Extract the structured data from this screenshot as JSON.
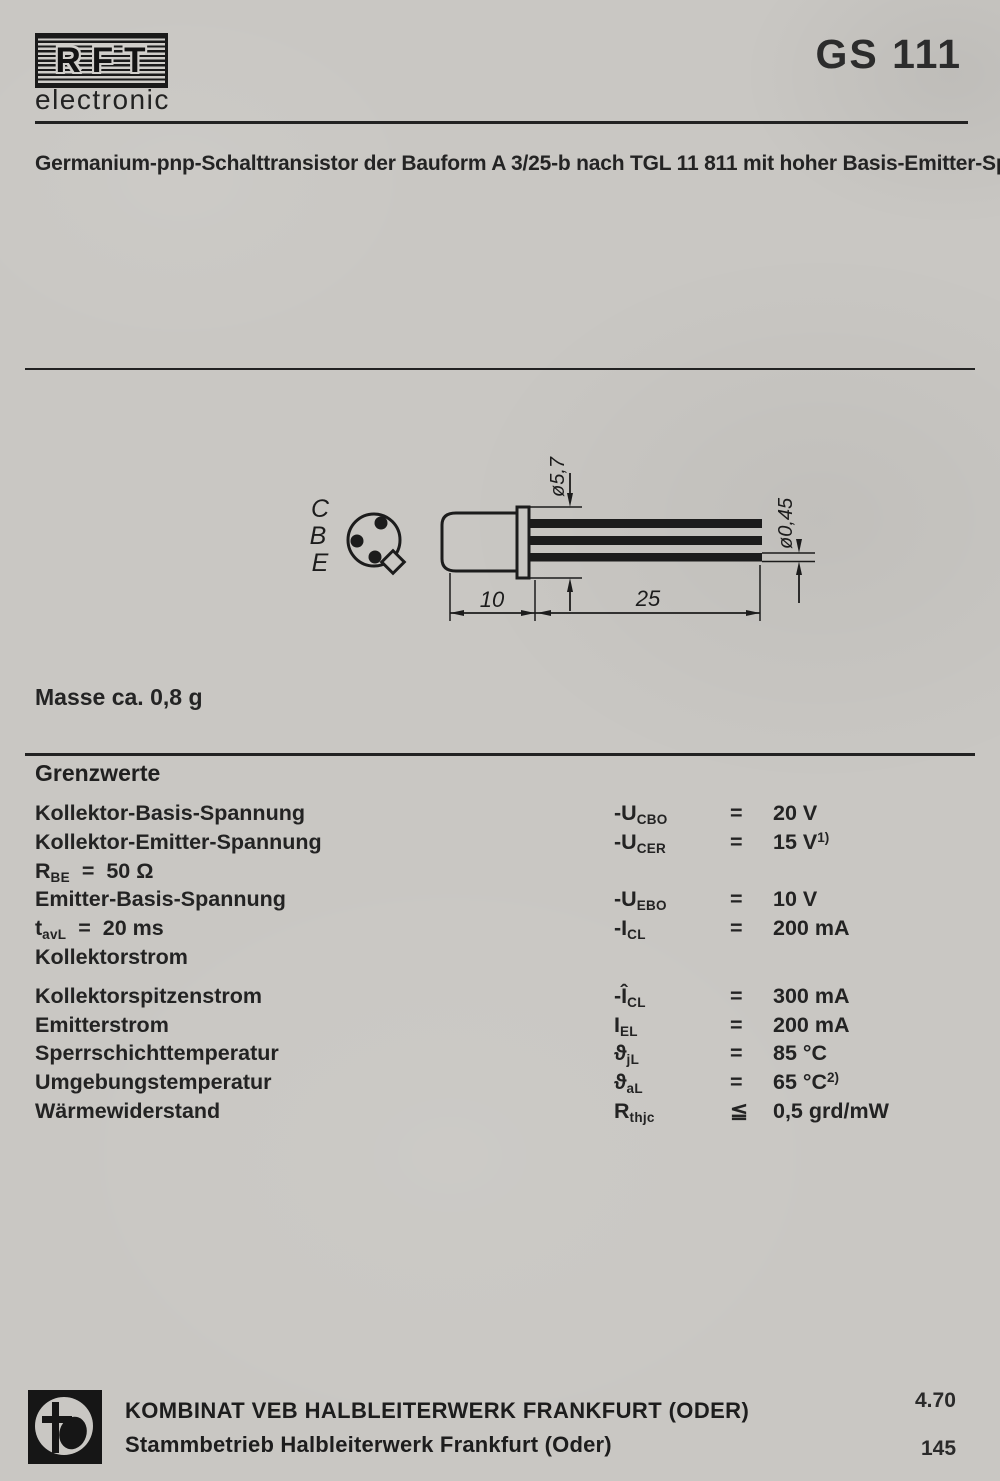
{
  "page": {
    "background": "#c9c7c3",
    "ink": "#1e1e1e"
  },
  "header": {
    "brand": "RFT",
    "brand_sub": "electronic",
    "model": "GS 111"
  },
  "description": "Germanium-pnp-Schalttransistor der Bauform A 3/25-b nach TGL 11 811 mit hoher Basis-Emitter-Spannungsfestigkeit für mittlere Geschwindigkeiten in logischen Schaltungen.",
  "drawing": {
    "pins": [
      "C",
      "B",
      "E"
    ],
    "dim_flange_diameter": "ø5,7",
    "dim_lead_diameter": "ø0,45",
    "dim_body_length": "10",
    "dim_lead_length": "25"
  },
  "mass_note": "Masse ca. 0,8 g",
  "limits": {
    "title": "Grenzwerte",
    "rows": [
      {
        "label": "Kollektor-Basis-Spannung",
        "sym": "-U",
        "sym_sub": "CBO",
        "rel": "=",
        "value": "20 V"
      },
      {
        "label": "Kollektor-Emitter-Spannung",
        "sym": "-U",
        "sym_sub": "CER",
        "rel": "=",
        "value": "15 V",
        "value_sup": "1)"
      },
      {
        "label": "R",
        "label_sub": "BE",
        "label_rest": "  =  50 Ω"
      },
      {
        "label": "Emitter-Basis-Spannung",
        "sym": "-U",
        "sym_sub": "EBO",
        "rel": "=",
        "value": "10 V"
      },
      {
        "label": "t",
        "label_sub": "avL",
        "label_rest": "  =  20 ms",
        "sym": "-I",
        "sym_sub": "CL",
        "rel": "=",
        "value": "200 mA"
      },
      {
        "label": "Kollektorstrom"
      },
      {
        "label": "Kollektorspitzenstrom",
        "sym": "-Î",
        "sym_sub": "CL",
        "rel": "=",
        "value": "300 mA"
      },
      {
        "label": "Emitterstrom",
        "sym": "I",
        "sym_sub": "EL",
        "rel": "=",
        "value": "200 mA"
      },
      {
        "label": "Sperrschichttemperatur",
        "sym": "ϑ",
        "sym_sub": "jL",
        "rel": "=",
        "value": "85 °C"
      },
      {
        "label": "Umgebungstemperatur",
        "sym": "ϑ",
        "sym_sub": "aL",
        "rel": "=",
        "value": "65 °C",
        "value_sup": "2)"
      },
      {
        "label": "Wärmewiderstand",
        "sym": "R",
        "sym_sub": "thjc",
        "rel": "≦",
        "value": "0,5 grd/mW"
      }
    ]
  },
  "footer": {
    "company_line1": "KOMBINAT VEB HALBLEITERWERK FRANKFURT (ODER)",
    "company_line2": "Stammbetrieb Halbleiterwerk Frankfurt (Oder)",
    "date_code": "4.70",
    "page_number": "145"
  }
}
